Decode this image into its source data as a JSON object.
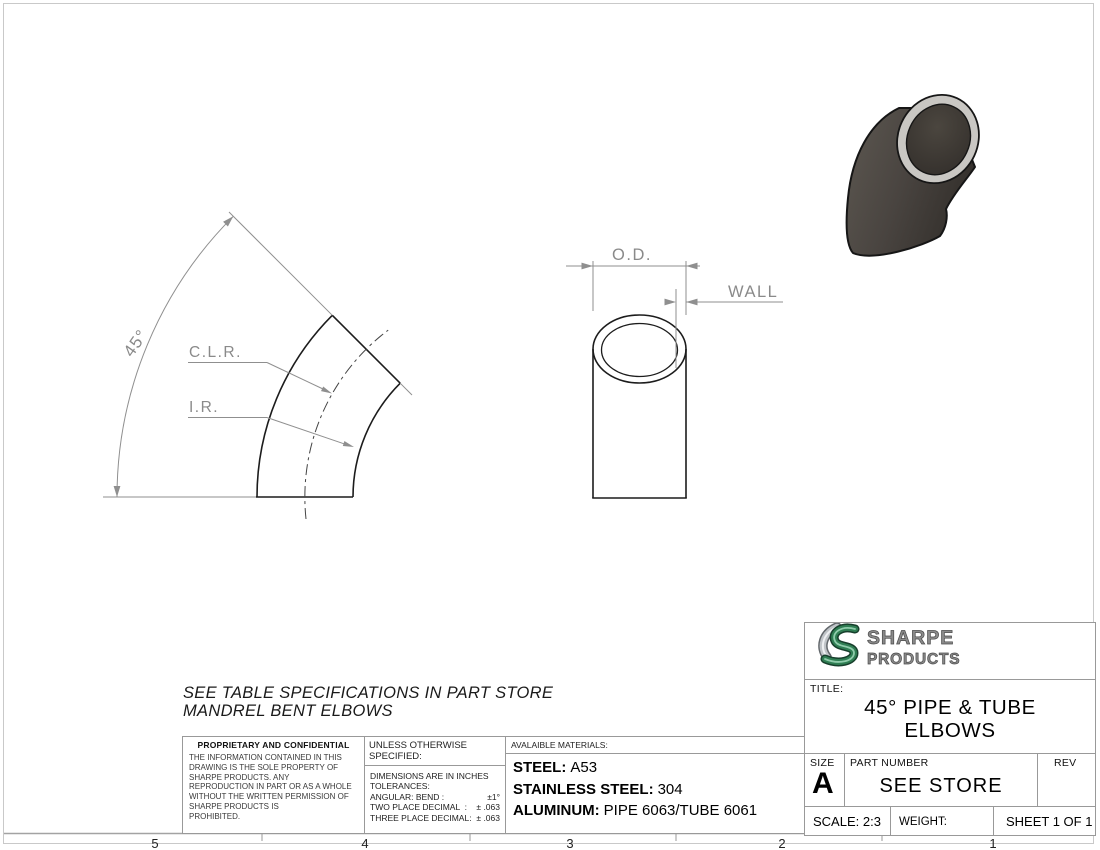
{
  "sheet": {
    "zones": [
      "5",
      "4",
      "3",
      "2",
      "1"
    ],
    "note_line1": "SEE TABLE SPECIFICATIONS IN PART STORE",
    "note_line2": "MANDREL BENT ELBOWS"
  },
  "drawing": {
    "angle_label": "45°",
    "clr_label": "C.L.R.",
    "ir_label": "I.R.",
    "od_label": "O.D.",
    "wall_label": "WALL"
  },
  "proprietary": {
    "title": "PROPRIETARY AND CONFIDENTIAL",
    "body": "THE INFORMATION CONTAINED IN THIS\nDRAWING IS THE SOLE PROPERTY OF\nSHARPE PRODUCTS.  ANY\nREPRODUCTION IN PART OR AS A WHOLE\nWITHOUT THE WRITTEN PERMISSION OF\nSHARPE PRODUCTS IS\nPROHIBITED."
  },
  "tolerances": {
    "header": "UNLESS OTHERWISE SPECIFIED:",
    "rows": [
      {
        "label": "DIMENSIONS ARE IN INCHES",
        "value": ""
      },
      {
        "label": "TOLERANCES:",
        "value": ""
      },
      {
        "label": "ANGULAR: BEND :",
        "value": "±1°"
      },
      {
        "label": "TWO PLACE DECIMAL  :",
        "value": "± .063"
      },
      {
        "label": "THREE PLACE DECIMAL:",
        "value": "± .063"
      }
    ]
  },
  "materials": {
    "header": "AVALAIBLE MATERIALS:",
    "rows": [
      {
        "label": "STEEL:",
        "value": "A53"
      },
      {
        "label": "STAINLESS STEEL:",
        "value": "304"
      },
      {
        "label": "ALUMINUM:",
        "value": "PIPE 6063/TUBE 6061"
      }
    ]
  },
  "titleblock": {
    "brand_line1": "SHARPE",
    "brand_line2": "PRODUCTS",
    "title_label": "TITLE:",
    "title_line1": "45° PIPE & TUBE",
    "title_line2": "ELBOWS",
    "size_label": "SIZE",
    "size_value": "A",
    "part_number_label": "PART NUMBER",
    "part_number_value": "SEE STORE",
    "rev_label": "REV",
    "scale_text": "SCALE: 2:3",
    "weight_text": "WEIGHT:",
    "sheet_text": "SHEET 1 OF 1"
  },
  "colors": {
    "edge_line": "#1c1c1c",
    "dim_line": "#8f8f8f",
    "border_gray": "#999999",
    "brand_green": "#2f7e53",
    "elbow_body": "#4c4741",
    "elbow_rim": "#c9c7c3"
  }
}
